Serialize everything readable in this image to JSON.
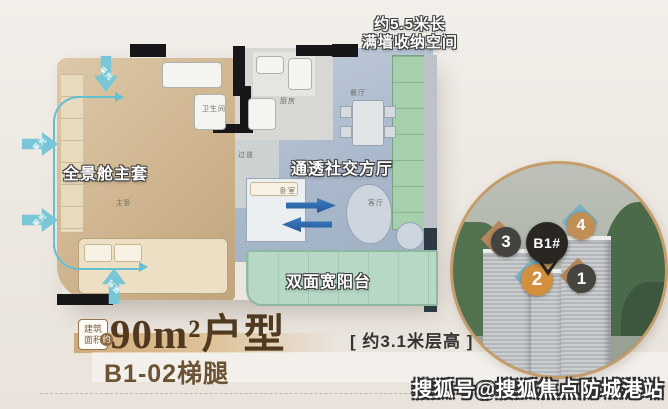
{
  "floorplan": {
    "callout_storage_line1": "约5.5米长",
    "callout_storage_line2": "满墙收纳空间",
    "callout_master": "全景舱主套",
    "callout_living": "通透社交方厅",
    "callout_balcony": "双面宽阳台",
    "daylight_label": "采光",
    "rooms": {
      "master_bath": "卫生间",
      "kitchen": "厨房",
      "hallway": "过道",
      "bedroom": "卧室",
      "living": "客厅",
      "dining": "餐厅",
      "master": "主卧"
    }
  },
  "caption": {
    "area_badge_line1": "建筑",
    "area_badge_line2": "面积",
    "area_badge_approx": "约",
    "headline": "90m²户型",
    "height_note": "[ 约3.1米层高 ]",
    "unit_label": "B1-02梯腿"
  },
  "inset": {
    "pin_label": "B1#",
    "markers": [
      {
        "num": "3"
      },
      {
        "num": "4"
      },
      {
        "num": "2"
      },
      {
        "num": "1"
      }
    ]
  },
  "watermark": "搜狐号@搜狐焦点防城港站",
  "colors": {
    "accent_teal": "#63c0d2",
    "accent_blue": "#2e6cb0",
    "headline_brown": "#50391f",
    "inset_border": "#c59d6c",
    "marker_orange": "#d28f3e",
    "marker_dark": "#45433f",
    "marker_tan_circle": "#c08f55",
    "diamond_tan": "#b4875a",
    "diamond_teal": "#7cb0bd",
    "balcony_green": "#b7d8c5",
    "storage_green": "#a6cfad",
    "suite_tan": "#cdb28c",
    "living_bluegray": "#aebccd"
  }
}
